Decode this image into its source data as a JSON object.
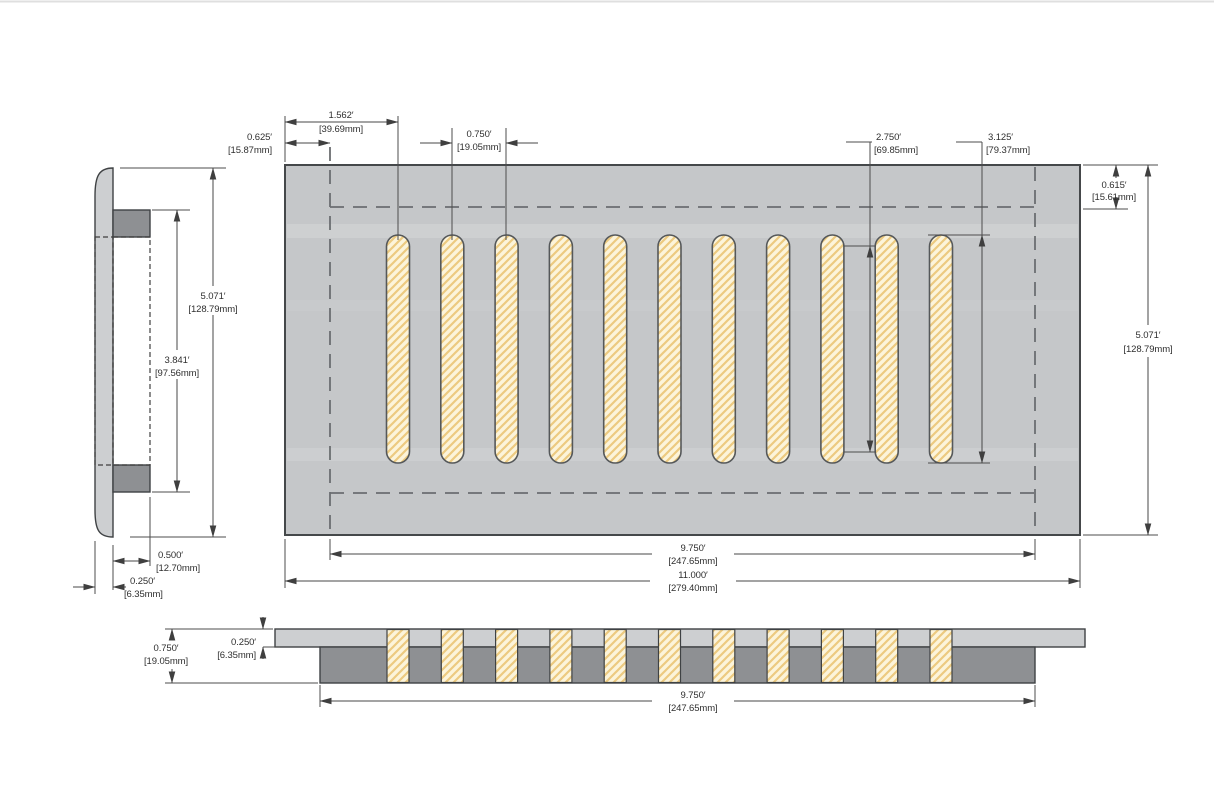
{
  "drawing": {
    "type": "dimensional-drawing",
    "subject": "slotted vent cover / floor register, three orthographic views",
    "units": "inches with millimeter conversions in brackets"
  },
  "geometry": {
    "slot_count": 11
  },
  "colors": {
    "plate_gray": "#c5c7c9",
    "light_gray": "#cdcfd1",
    "dark_gray": "#8e9093",
    "slot_cream": "#fcf4da",
    "hatch_tan": "#ecca80",
    "plain_tan": "#e7d3a6",
    "line_dark": "#45484a",
    "dim_gray": "#474747"
  },
  "dimensions": {
    "front": {
      "first_slot_offset": {
        "in": "1.562′",
        "mm": "[39.69mm]"
      },
      "edge_to_opening": {
        "in": "0.625′",
        "mm": "[15.87mm]"
      },
      "slot_pitch": {
        "in": "0.750′",
        "mm": "[19.05mm]"
      },
      "slot_inner_length": {
        "in": "2.750′",
        "mm": "[69.85mm]"
      },
      "slot_length": {
        "in": "3.125′",
        "mm": "[79.37mm]"
      },
      "top_margin": {
        "in": "0.615′",
        "mm": "[15.61mm]"
      },
      "height": {
        "in": "5.071′",
        "mm": "[128.79mm]"
      },
      "opening_width": {
        "in": "9.750′",
        "mm": "[247.65mm]"
      },
      "overall_width": {
        "in": "11.000′",
        "mm": "[279.40mm]"
      }
    },
    "side": {
      "height": {
        "in": "5.071′",
        "mm": "[128.79mm]"
      },
      "inner_height": {
        "in": "3.841′",
        "mm": "[97.56mm]"
      },
      "drop_in_depth": {
        "in": "0.500′",
        "mm": "[12.70mm]"
      },
      "flange_thickness": {
        "in": "0.250′",
        "mm": "[6.35mm]"
      }
    },
    "bottom": {
      "overall_depth": {
        "in": "0.750′",
        "mm": "[19.05mm]"
      },
      "plate_thickness": {
        "in": "0.250′",
        "mm": "[6.35mm]"
      },
      "opening_width": {
        "in": "9.750′",
        "mm": "[247.65mm]"
      }
    }
  }
}
